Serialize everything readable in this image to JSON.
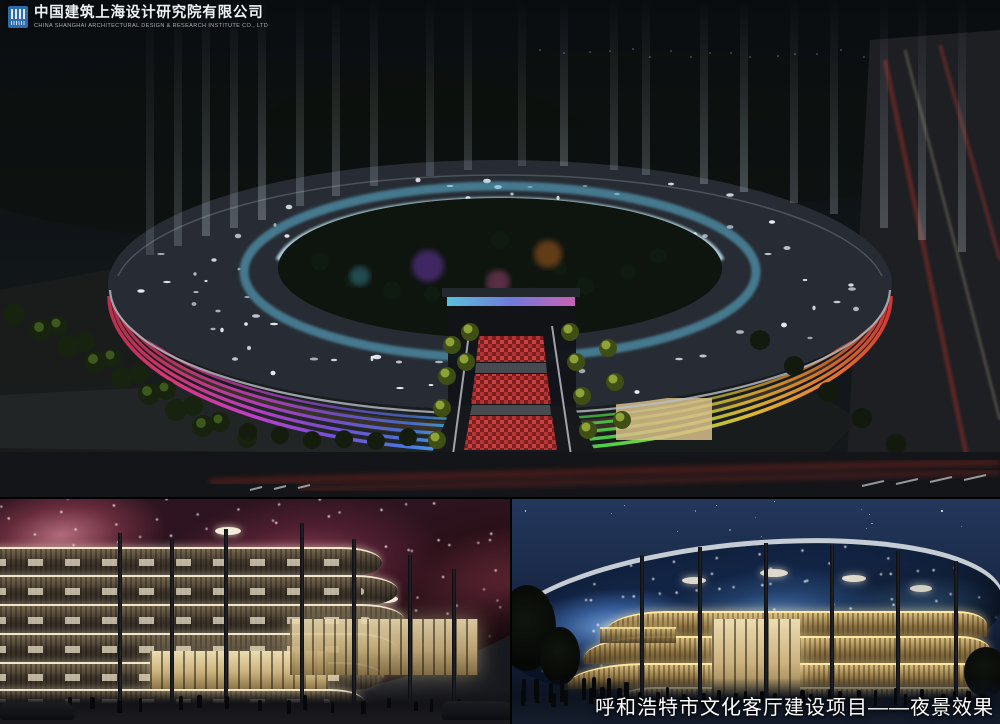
{
  "header": {
    "company_name_cn": "中国建筑上海设计研究院有限公司",
    "company_name_en": "CHINA SHANGHAI ARCHITECTURAL DESIGN & RESEARCH INSTITUTE CO., LTD",
    "logo": {
      "name": "cscec-logo",
      "bg_color": "#2e6cac"
    }
  },
  "caption": {
    "text": "呼和浩特市文化客厅建设项目——夜景效果"
  },
  "palette": {
    "sky_top": "#0a0d10",
    "roof": "#282d35",
    "inner_ring_glass": "#7fd8f2",
    "facade_glow_left": [
      "#e2397e",
      "#c93fd0",
      "#7e52e2",
      "#43c8ea"
    ],
    "facade_glow_right": [
      "#3fd060",
      "#a8d838",
      "#e8c030",
      "#e85530"
    ],
    "walkway_red": "#c03030",
    "nebula_canopy_pink": "#8a4055",
    "canopy_blue": "#3a64a4",
    "band_gold": "#c8a860",
    "night_sky_blue": "#24385c"
  }
}
